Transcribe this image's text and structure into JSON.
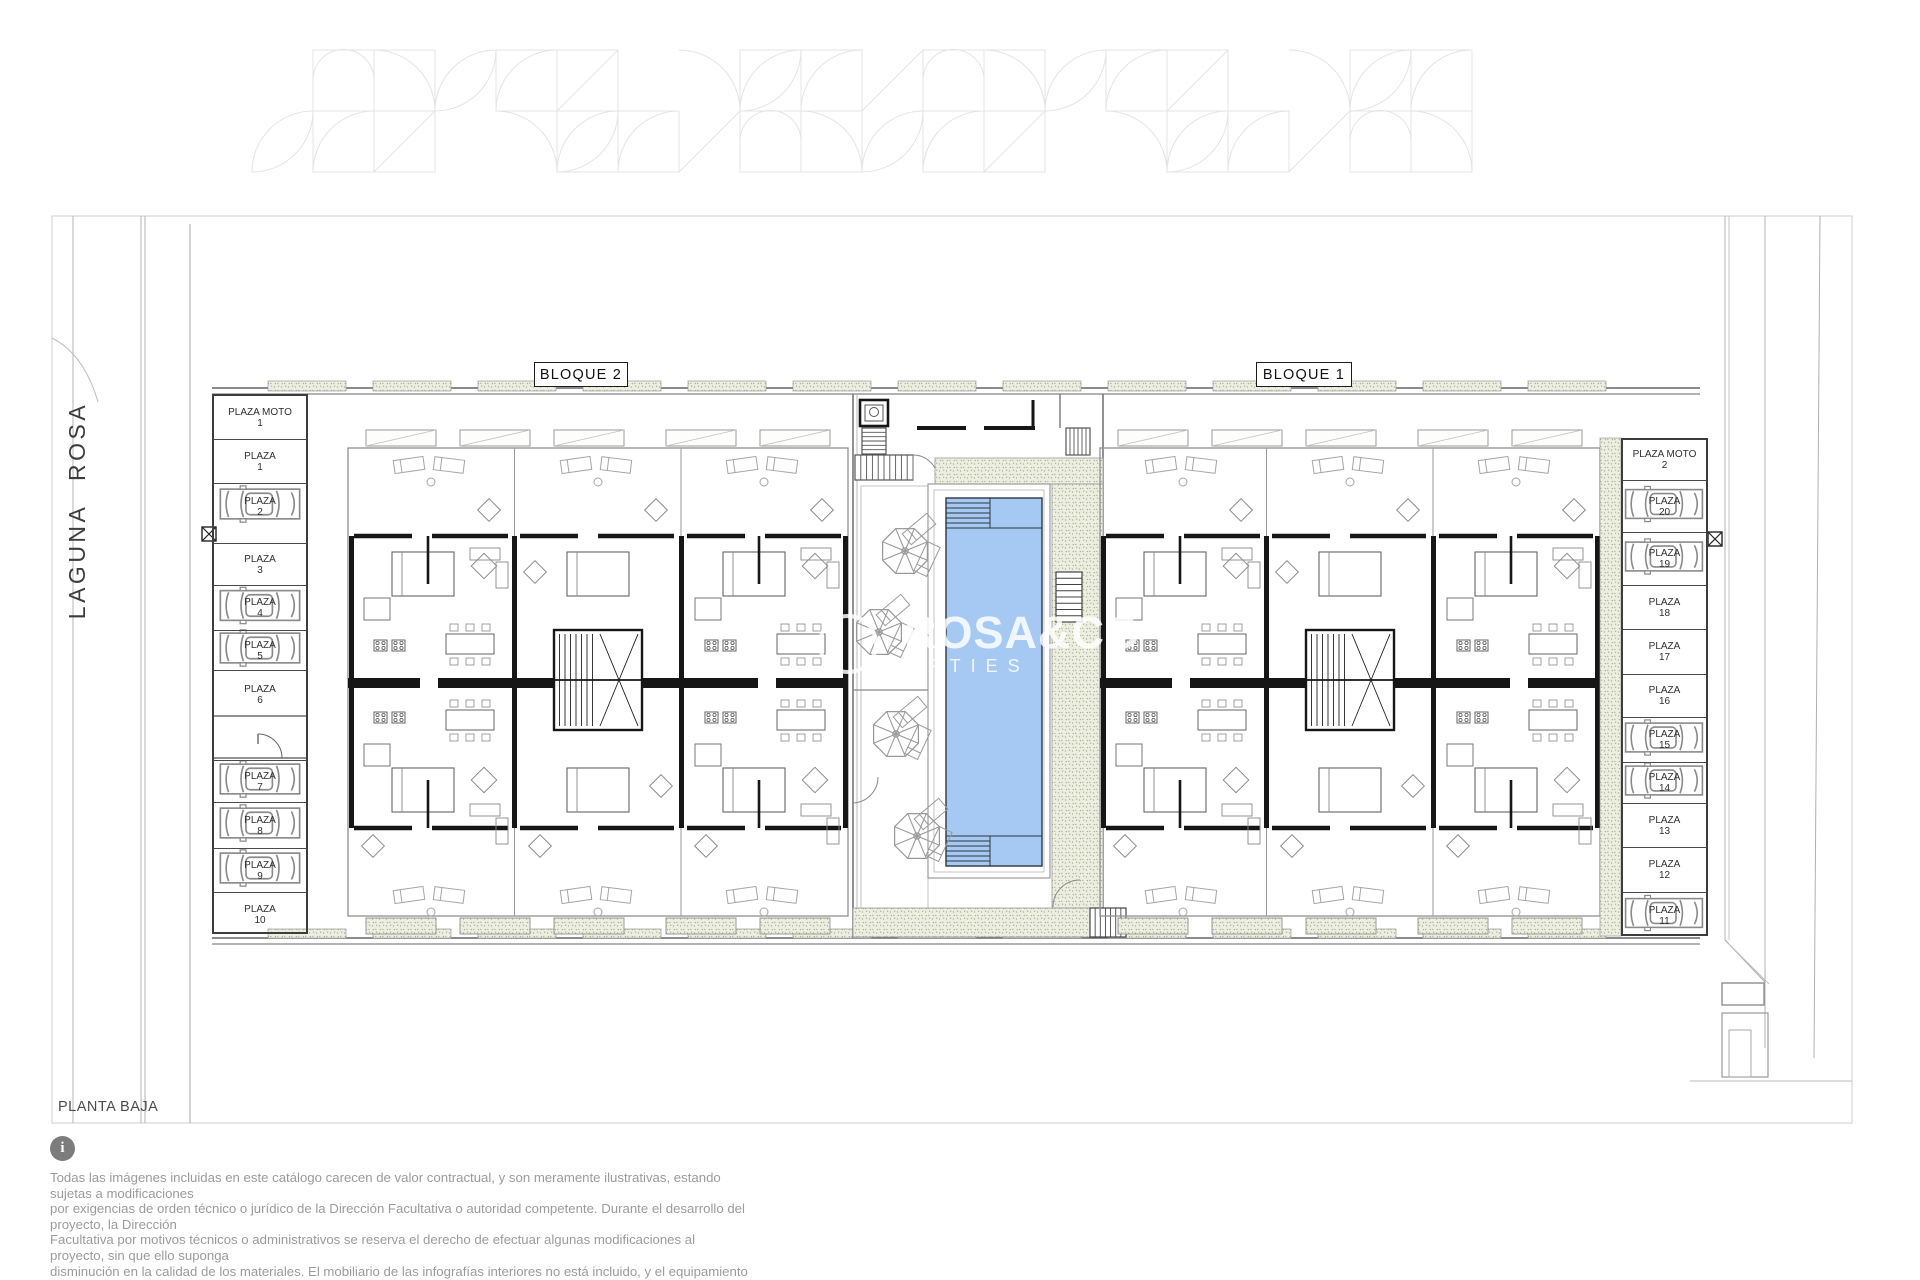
{
  "document": {
    "plan_title": "PLANTA BAJA"
  },
  "street": {
    "name": "LAGUNA ROSA"
  },
  "blocks": [
    {
      "label": "BLOQUE 2"
    },
    {
      "label": "BLOQUE 1"
    }
  ],
  "parking": {
    "left": [
      {
        "label": "PLAZA MOTO",
        "number": "1",
        "car": false
      },
      {
        "label": "PLAZA",
        "number": "1",
        "car": false
      },
      {
        "label": "PLAZA",
        "number": "2",
        "car": true
      },
      {
        "label": "PLAZA",
        "number": "3",
        "car": false
      },
      {
        "label": "PLAZA",
        "number": "4",
        "car": true
      },
      {
        "label": "PLAZA",
        "number": "5",
        "car": true
      },
      {
        "label": "PLAZA",
        "number": "6",
        "car": false
      },
      {
        "label": "PLAZA",
        "number": "7",
        "car": true
      },
      {
        "label": "PLAZA",
        "number": "8",
        "car": true
      },
      {
        "label": "PLAZA",
        "number": "9",
        "car": true
      },
      {
        "label": "PLAZA",
        "number": "10",
        "car": false
      }
    ],
    "right": [
      {
        "label": "PLAZA MOTO",
        "number": "2",
        "car": false
      },
      {
        "label": "PLAZA",
        "number": "20",
        "car": true
      },
      {
        "label": "PLAZA",
        "number": "19",
        "car": true
      },
      {
        "label": "PLAZA",
        "number": "18",
        "car": false
      },
      {
        "label": "PLAZA",
        "number": "17",
        "car": false
      },
      {
        "label": "PLAZA",
        "number": "16",
        "car": false
      },
      {
        "label": "PLAZA",
        "number": "15",
        "car": true
      },
      {
        "label": "PLAZA",
        "number": "14",
        "car": true
      },
      {
        "label": "PLAZA",
        "number": "13",
        "car": false
      },
      {
        "label": "PLAZA",
        "number": "12",
        "car": false
      },
      {
        "label": "PLAZA",
        "number": "11",
        "car": true
      }
    ]
  },
  "watermark": {
    "line1": "ROSA&CO",
    "line2": "RTIES"
  },
  "footer": {
    "info_glyph": "i",
    "disclaimer": [
      "Todas las imágenes incluidas en este catálogo carecen de valor contractual, y son meramente ilustrativas, estando sujetas a modificaciones",
      "por exigencias de  orden técnico o jurídico de la Dirección Facultativa o autoridad competente. Durante el desarrollo del proyecto, la Dirección",
      "Facultativa por motivos técnicos o administrativos se reserva el derecho de efectuar algunas modificaciones al proyecto, sin que ello suponga",
      "disminución  en la calidad de los materiales. El mobiliario de las infografías interiores no está incluido, y el equipamiento de las viviendas será",
      "el indicado en la correspondiente memoria de calidades."
    ]
  },
  "colors": {
    "pool_water": "#a5c9f2",
    "pool_edge": "#2e3640",
    "deck_base": "#edeee2",
    "deck_dot": "#a8b48e",
    "wall": "#161616",
    "line_dark": "#4a4a4a",
    "line_mid": "#8a8a8a",
    "line_light": "#bcbcbc",
    "pattern_line": "#e4e4e8"
  }
}
